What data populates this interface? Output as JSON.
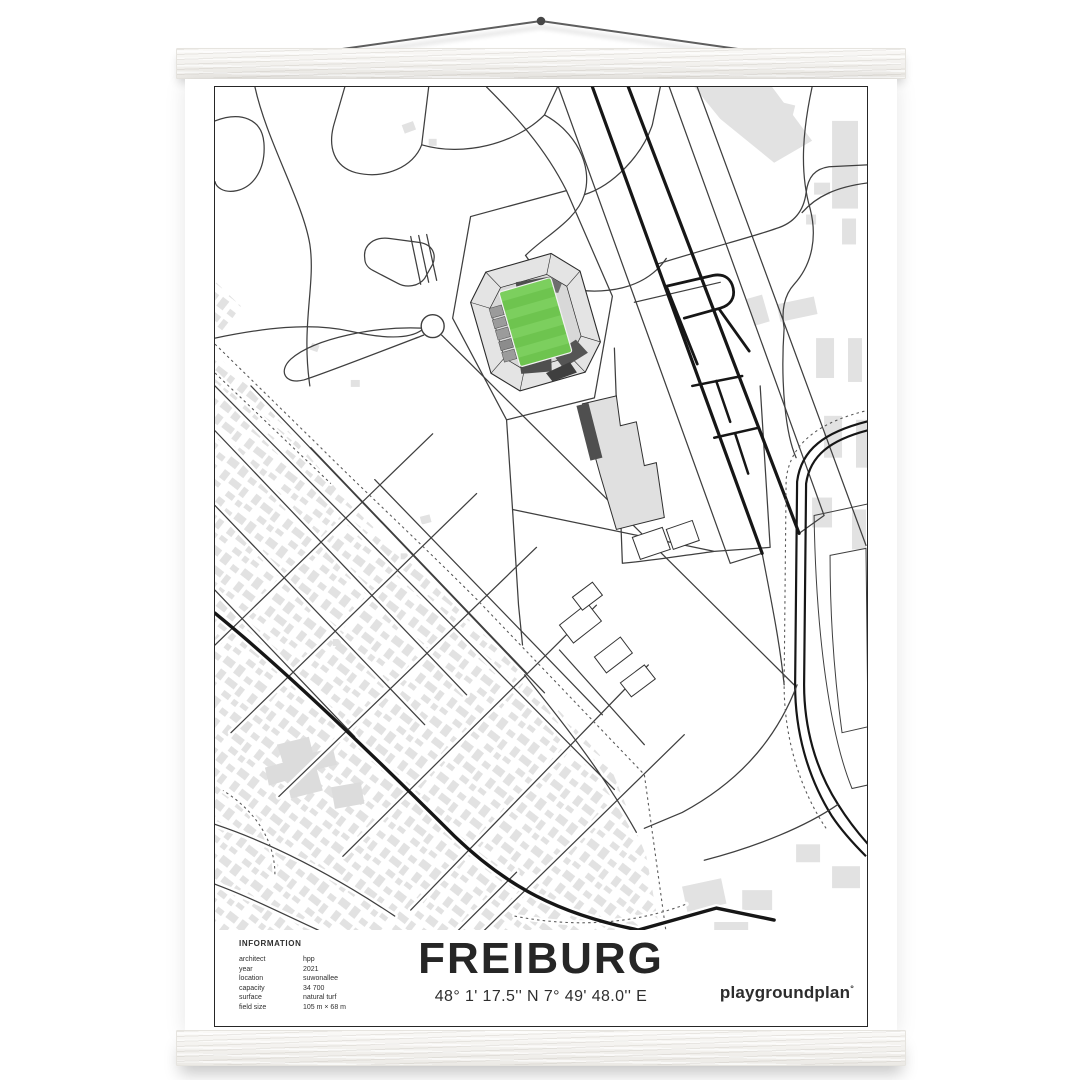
{
  "poster": {
    "title": "FREIBURG",
    "coordinates": "48° 1' 17.5'' N  7° 49' 48.0'' E",
    "brand": "playgroundplan",
    "brand_mark": "°",
    "info": {
      "heading": "INFORMATION",
      "rows": [
        {
          "label": "architect",
          "value": "hpp"
        },
        {
          "label": "year",
          "value": "2021"
        },
        {
          "label": "location",
          "value": "suwonallee"
        },
        {
          "label": "capacity",
          "value": "34 700"
        },
        {
          "label": "surface",
          "value": "natural turf"
        },
        {
          "label": "field size",
          "value": "105 m × 68 m"
        }
      ]
    }
  },
  "colors": {
    "pitch_green": "#6ec44f",
    "pitch_green_light": "#7ccf5e",
    "building_gray": "#e2e2e2",
    "road_gray": "#3f3f3f",
    "major_road_black": "#161616",
    "stand_dark": "#4f4f4f",
    "wood_white": "#f5f4f1"
  }
}
